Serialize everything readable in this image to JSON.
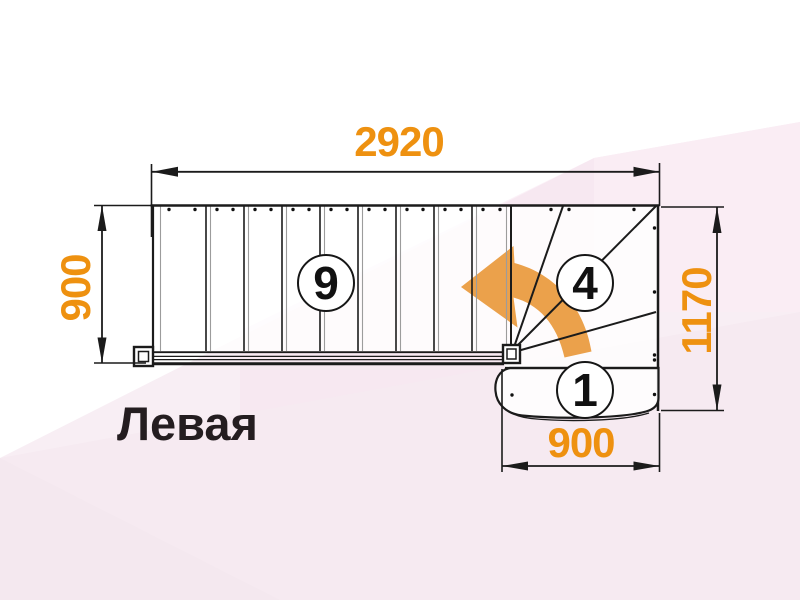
{
  "diagram": {
    "type": "staircase-plan",
    "side_label": "Левая",
    "dimensions": {
      "top_width": "2920",
      "left_height": "900",
      "right_height": "1170",
      "bottom_width": "900"
    },
    "step_markers": {
      "straight_steps": "9",
      "winder_steps": "4",
      "first_step": "1"
    },
    "icons": {
      "turn_arrow": "curved-left-turn-arrow"
    },
    "colors": {
      "dimension_text": "#EE9110",
      "turn_arrow_fill": "#EBA14B",
      "outline": "#1B1B1B",
      "side_label_text": "#241D20",
      "background": "#F8EEF4"
    }
  }
}
